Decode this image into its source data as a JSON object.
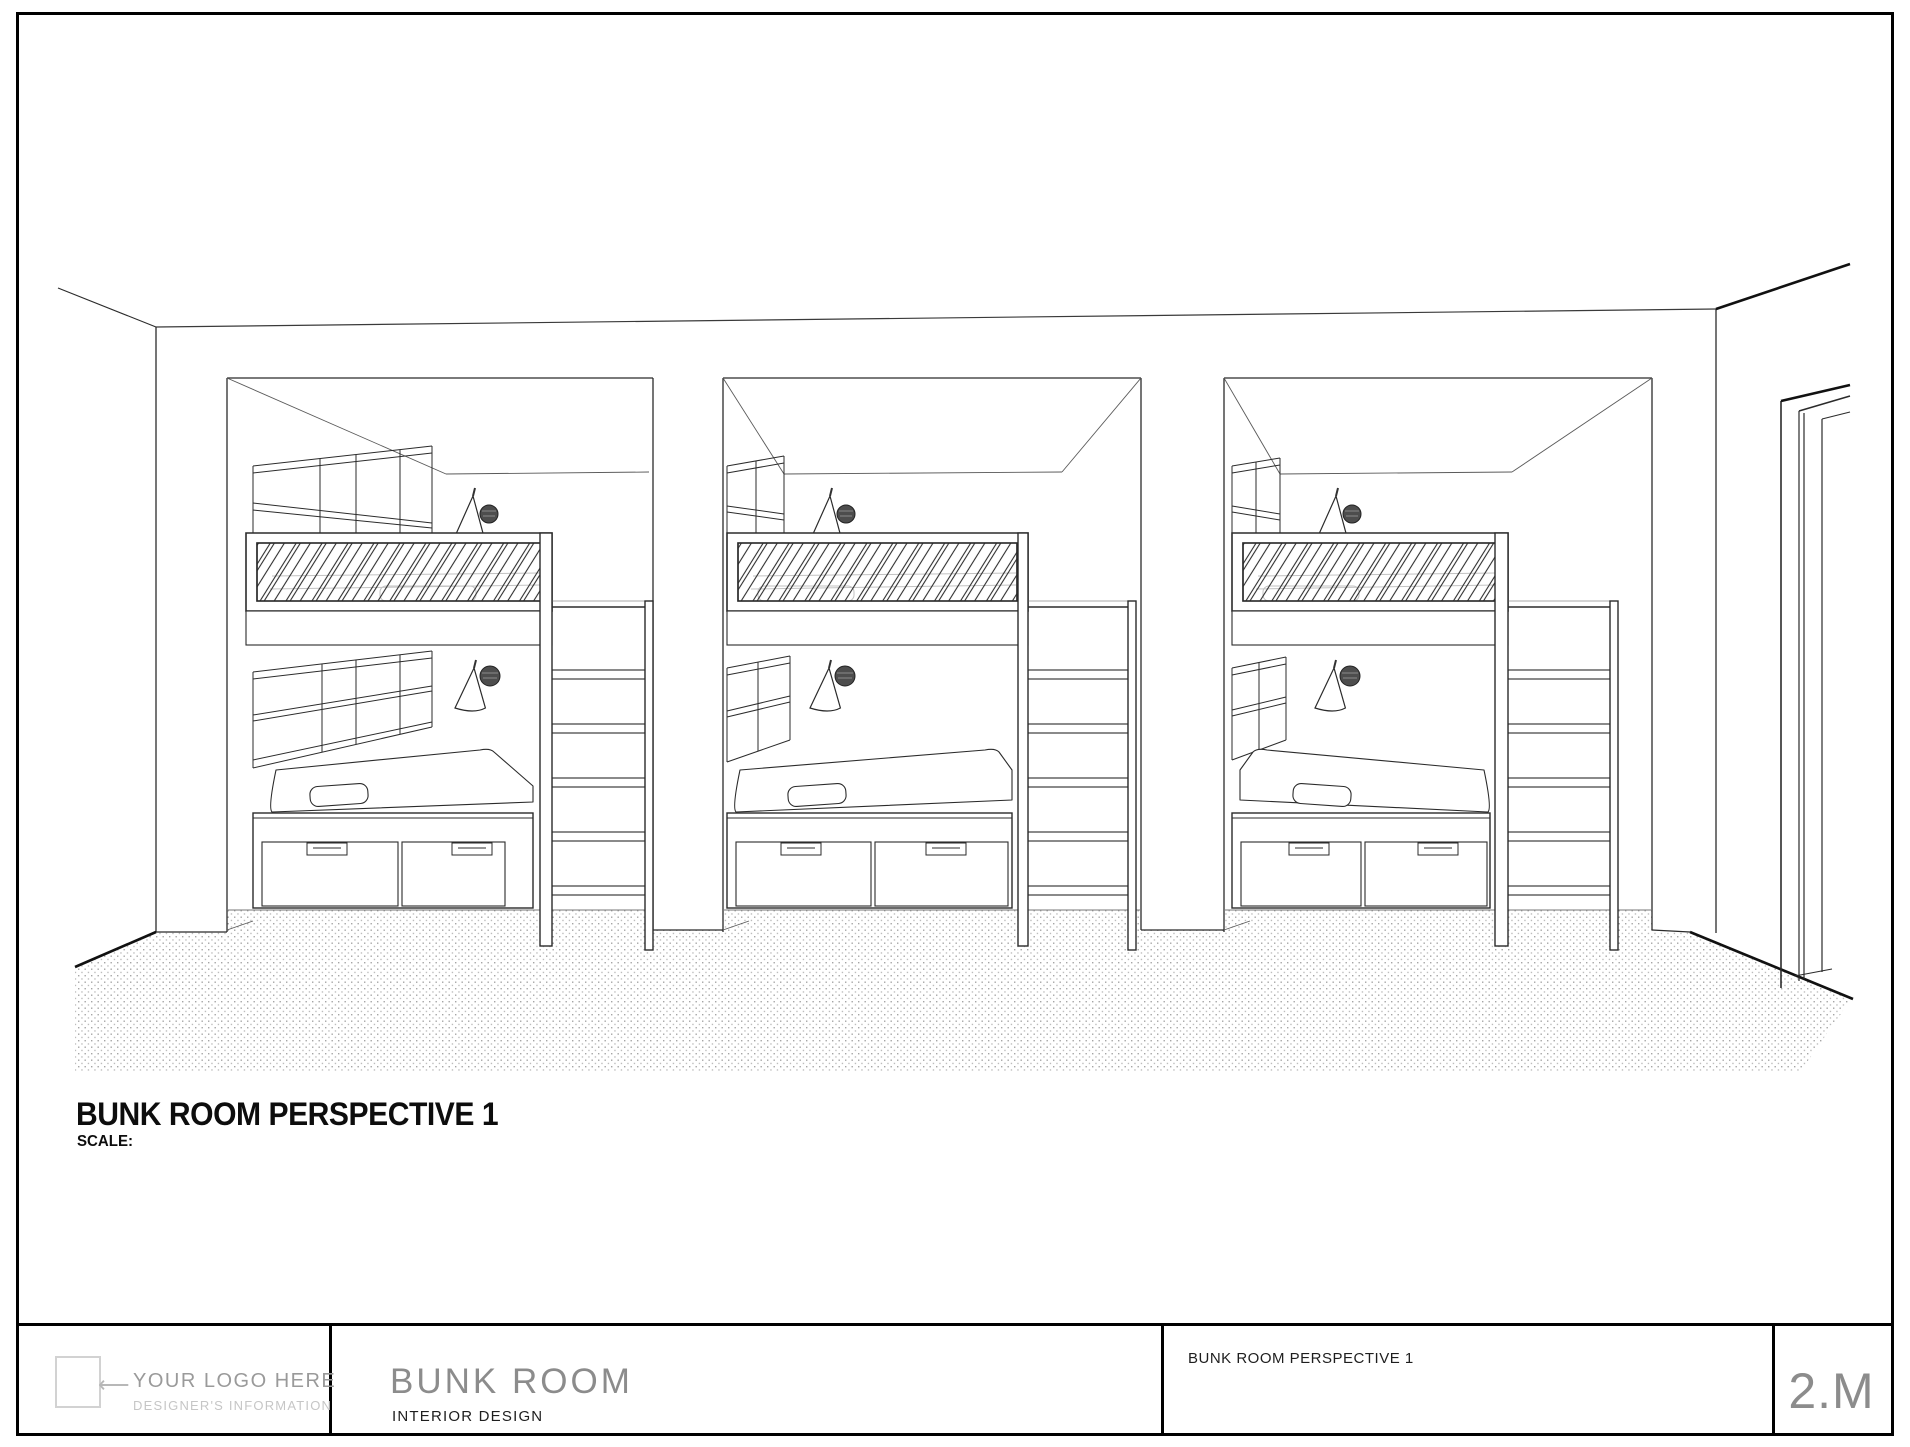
{
  "sheet": {
    "drawing_title": "BUNK ROOM PERSPECTIVE 1",
    "scale_label": "SCALE:",
    "title_block": {
      "logo_placeholder_arrow": "⟵",
      "logo_placeholder_line1": "YOUR LOGO HERE",
      "logo_placeholder_line2": "DESIGNER'S INFORMATION",
      "project_name": "BUNK ROOM",
      "project_subtitle": "INTERIOR DESIGN",
      "view_title": "BUNK ROOM PERSPECTIVE 1",
      "sheet_number": "2.M"
    }
  },
  "colors": {
    "ink": "#2b2b2b",
    "dark_ink": "#111111",
    "light_ink": "#5a5a5a",
    "faint_ink": "#c2c2c2",
    "floor_dot": "#a5a5a5",
    "sconce_fill": "#4d4d4d",
    "logo_gray": "#9a9a9a"
  }
}
